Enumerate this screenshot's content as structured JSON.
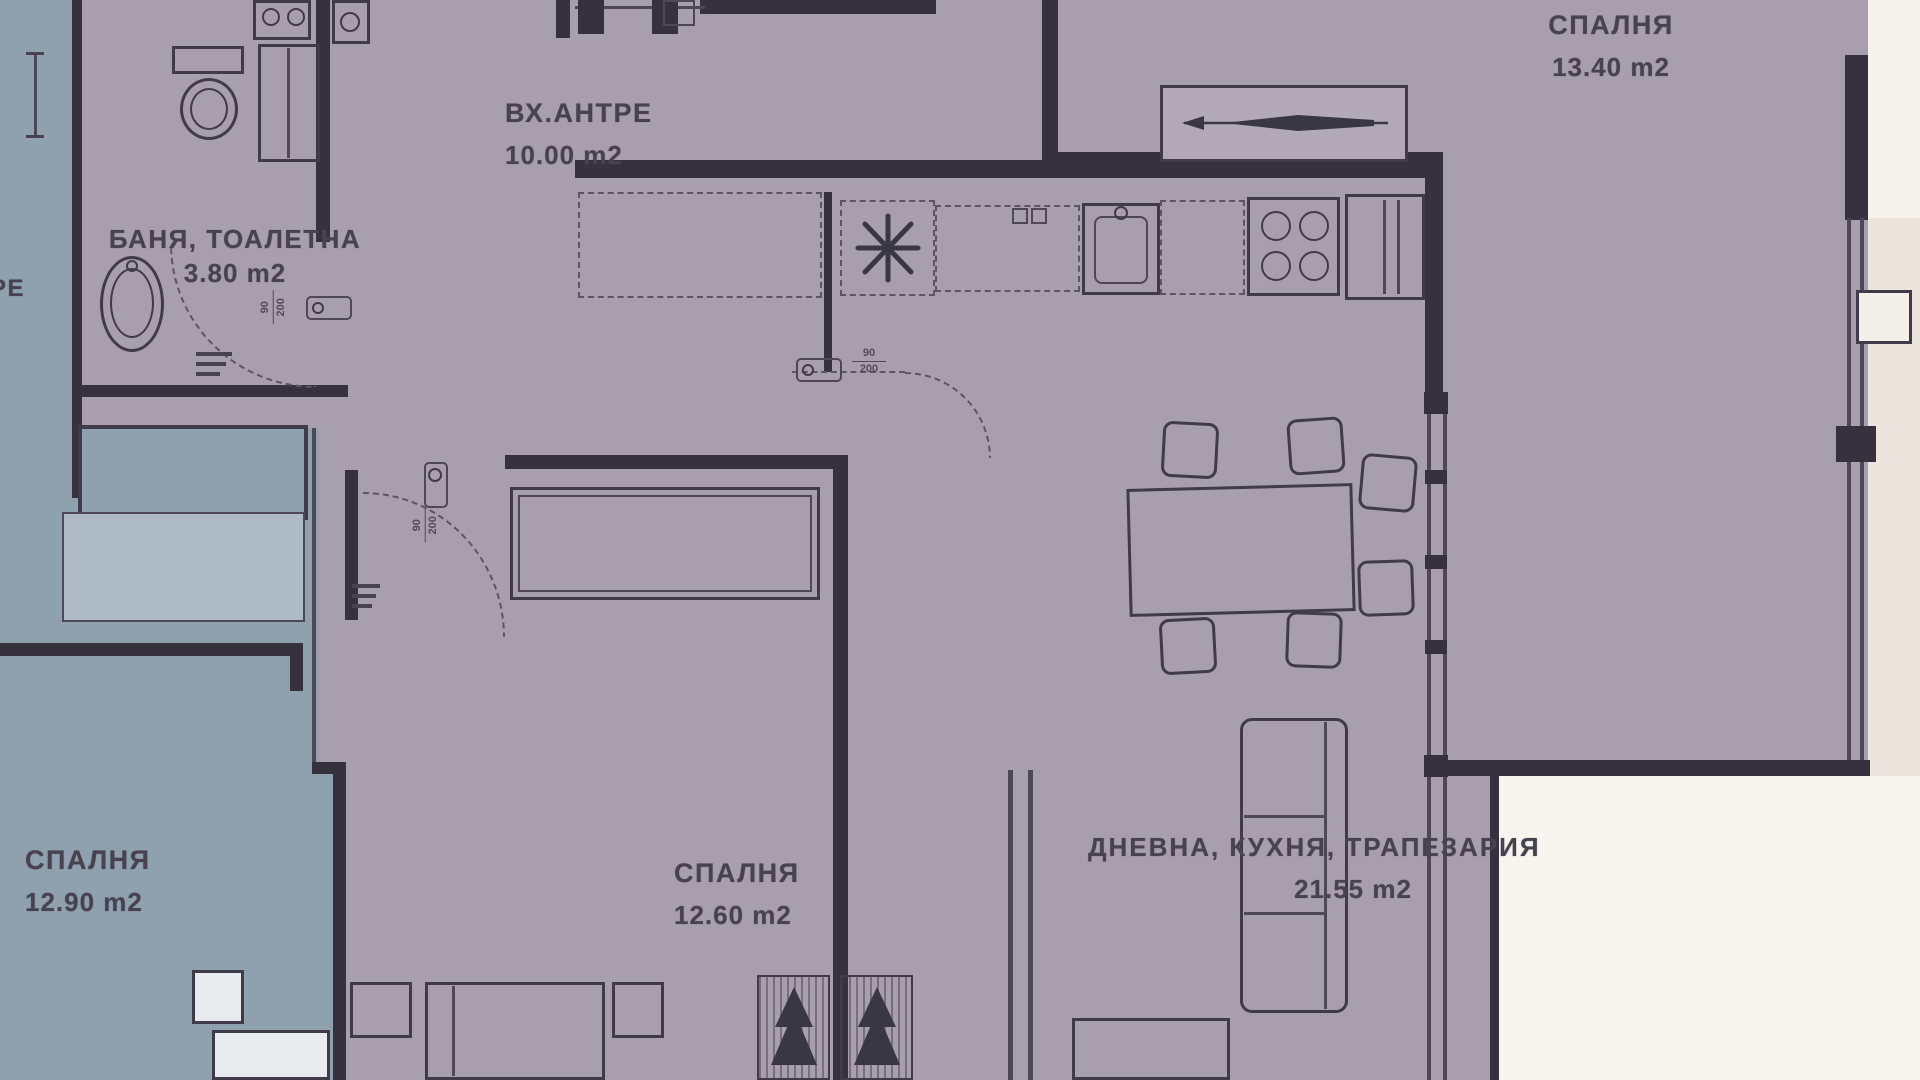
{
  "plan": {
    "kind": "apartment floor plan",
    "language": "bg"
  },
  "colors": {
    "floor_main": "#a79fad",
    "floor_neighbor": "#8fa0af",
    "wall": "#35323e",
    "outside_top_right": "#f6f2ec",
    "outside_right": "#ece5dd",
    "outside_bottom_right": "#f8f5f0",
    "label_text": "#474250"
  },
  "rooms": [
    {
      "key": "bedroom_top_right",
      "name": "СПАЛНЯ",
      "area": "13.40 m2"
    },
    {
      "key": "entrance_hall",
      "name": "ВХ.АНТРЕ",
      "area": "10.00 m2"
    },
    {
      "key": "bathroom",
      "name": "БАНЯ, ТОАЛЕТНА",
      "area": "3.80 m2"
    },
    {
      "key": "bedroom_left_neighbor",
      "name": "СПАЛНЯ",
      "area": "12.90 m2"
    },
    {
      "key": "bedroom_center",
      "name": "СПАЛНЯ",
      "area": "12.60 m2"
    },
    {
      "key": "living_kitchen_dining",
      "name": "ДНЕВНА, КУХНЯ, ТРАПЕЗАРИЯ",
      "area": "21.55 m2"
    }
  ],
  "annotations": {
    "door_width": "90",
    "door_height": "200",
    "left_edge_partial_label": "РЕ"
  }
}
